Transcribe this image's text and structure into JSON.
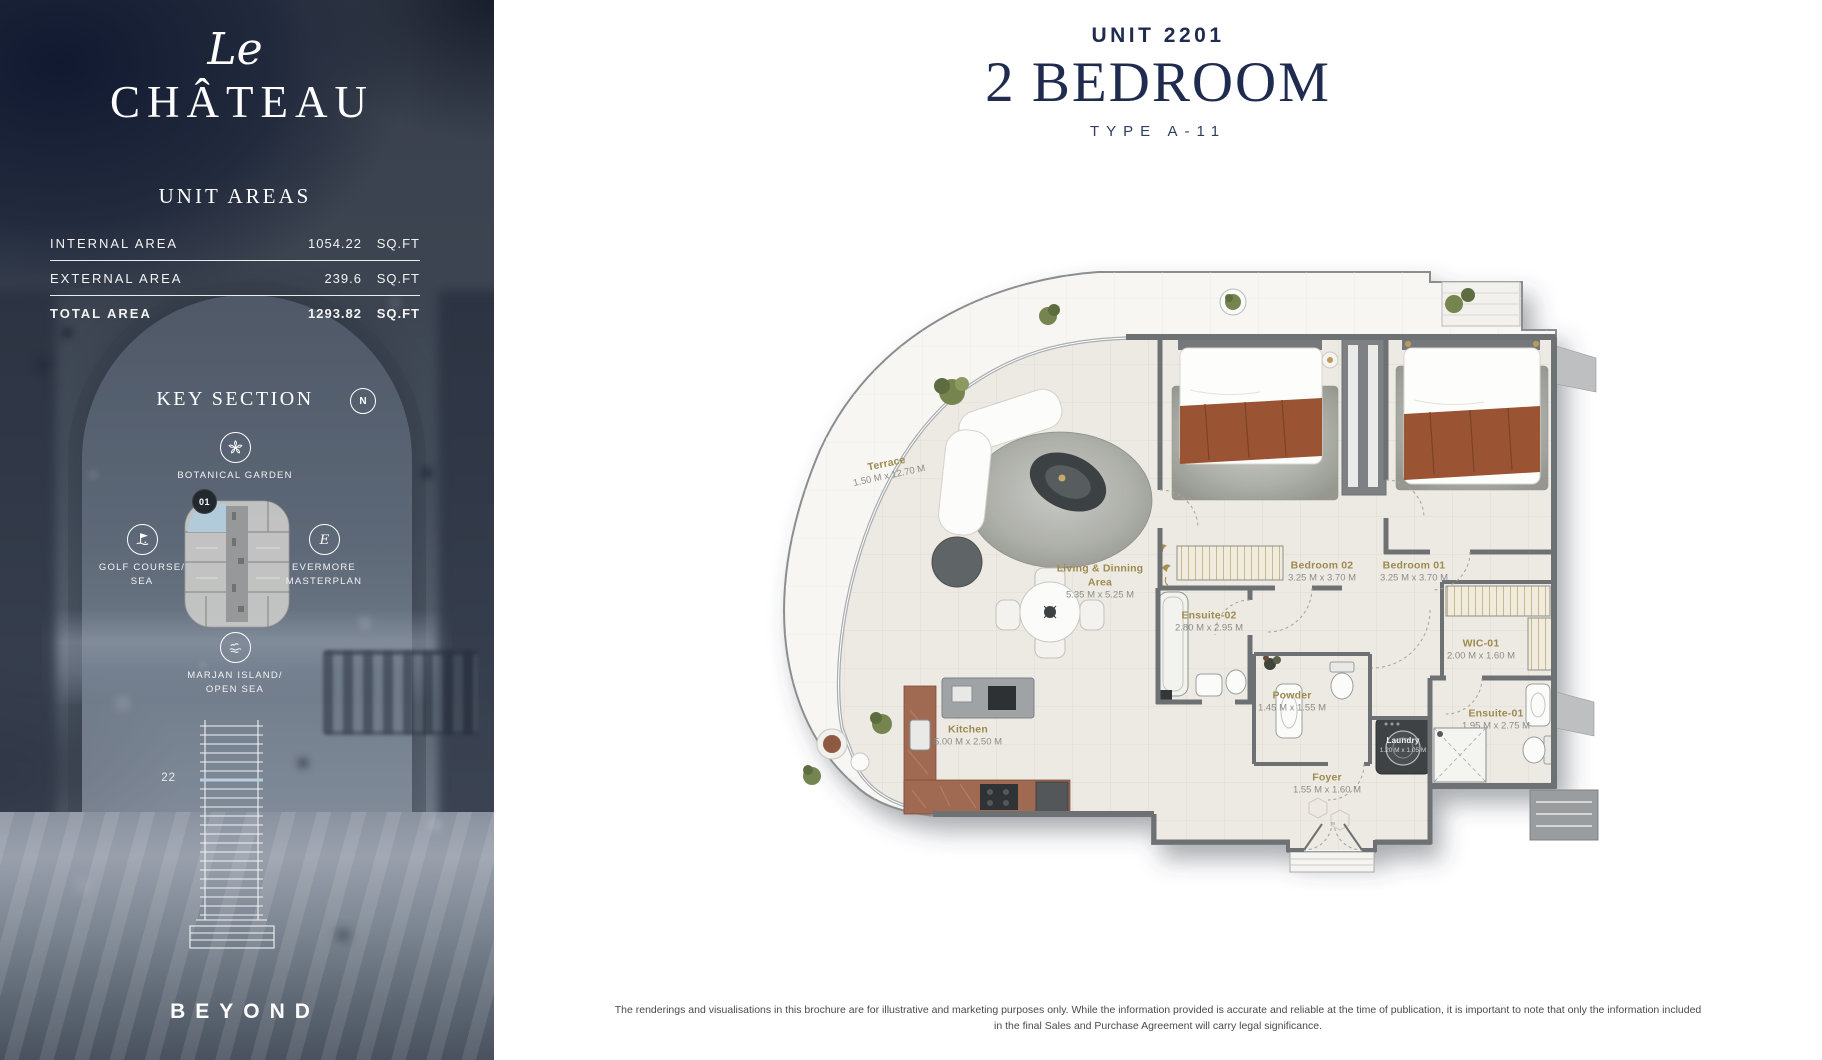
{
  "sidebar": {
    "logo_script": "Le",
    "logo_name": "CHÂTEAU",
    "unit_areas_title": "UNIT AREAS",
    "areas": {
      "internal_label": "INTERNAL AREA",
      "internal_value": "1054.22",
      "internal_unit": "SQ.FT",
      "external_label": "EXTERNAL AREA",
      "external_value": "239.6",
      "external_unit": "SQ.FT",
      "total_label": "TOTAL AREA",
      "total_value": "1293.82",
      "total_unit": "SQ.FT"
    },
    "key_section_title": "KEY SECTION",
    "compass_label": "N",
    "unit_badge": "01",
    "floor_number": "22",
    "legend": {
      "botanical": "BOTANICAL GARDEN",
      "golf": "GOLF COURSE/\nSEA",
      "evermore": "EVERMORE\nMASTERPLAN",
      "marjan": "MARJAN ISLAND/\nOPEN SEA"
    },
    "footer_logo": "BEYOND"
  },
  "header": {
    "unit_number": "UNIT 2201",
    "title": "2 BEDROOM",
    "type": "TYPE A-11"
  },
  "plan": {
    "rooms": {
      "terrace": {
        "name": "Terrace",
        "dims": "1.50 M x 12.70 M"
      },
      "living": {
        "name": "Living & Dinning Area",
        "dims": "5.35 M x 5.25 M"
      },
      "kitchen": {
        "name": "Kitchen",
        "dims": "5.00 M x 2.50 M"
      },
      "bedroom02": {
        "name": "Bedroom 02",
        "dims": "3.25 M x 3.70 M"
      },
      "bedroom01": {
        "name": "Bedroom 01",
        "dims": "3.25 M x 3.70 M"
      },
      "ensuite02": {
        "name": "Ensuite-02",
        "dims": "2.80 M x 2.95 M"
      },
      "wic01": {
        "name": "WIC-01",
        "dims": "2.00 M x 1.60 M"
      },
      "powder": {
        "name": "Powder",
        "dims": "1.45 M x 1.55 M"
      },
      "ensuite01": {
        "name": "Ensuite-01",
        "dims": "1.95 M x 2.75 M"
      },
      "laundry": {
        "name": "Laundry",
        "dims": "1.20 M x 1.05 M"
      },
      "foyer": {
        "name": "Foyer",
        "dims": "1.55 M x 1.60 M"
      }
    }
  },
  "footer": {
    "disclaimer_line1": "The renderings and visualisations in this brochure are for illustrative and marketing purposes only. While the information provided is accurate and reliable at the time of publication, it is important to note that only the information included",
    "disclaimer_line2": "in the final Sales and Purchase Agreement will carry legal significance."
  },
  "icons": {
    "compass": "compass-n-icon",
    "botanical": "flower-icon",
    "golf": "golf-flag-icon",
    "evermore": "script-e-icon",
    "marjan": "bird-waves-icon"
  },
  "colors": {
    "accent_navy": "#1F2C50",
    "label_gold": "#9D8A50",
    "dims_gray": "#8C8C89",
    "sidebar_dark": "#3B424F"
  }
}
